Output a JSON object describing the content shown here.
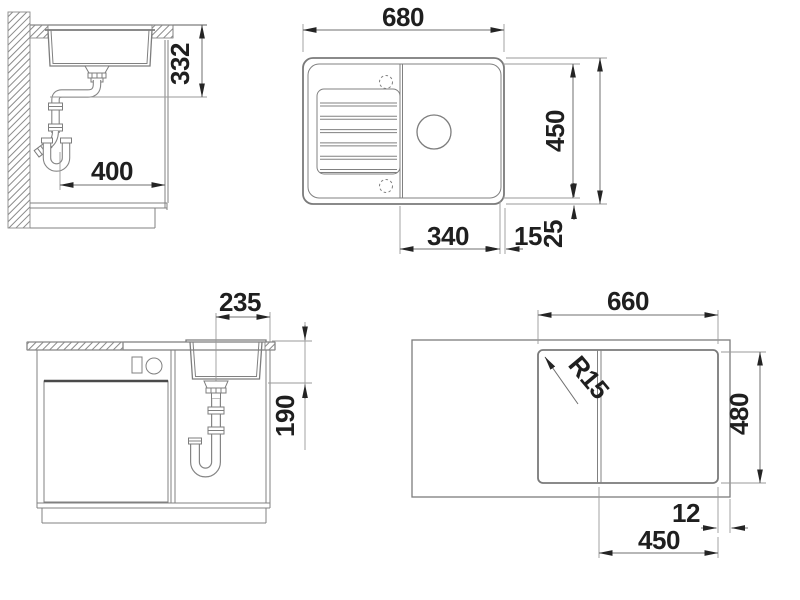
{
  "page": {
    "background_color": "#ffffff",
    "line_color": "#808080",
    "text_color": "#1f1f1f"
  },
  "drawing": {
    "type": "sink-installation-technical-drawing",
    "views": {
      "side_section": {
        "description": "side cross-section with wall, countertop, bowl and drain trap",
        "dims": {
          "counter_to_drain_height": "332",
          "wall_to_cabinet_front": "400"
        }
      },
      "plan": {
        "description": "top view of sink with drainboard, bowl, drain and tap holes",
        "dims": {
          "overall_width": "680",
          "inner_depth": "450",
          "overall_depth": "500",
          "bowl_width": "340",
          "rim_right": "15",
          "rim_bottom": "25"
        }
      },
      "front_section": {
        "description": "front view of base cabinet with bowl and siphon",
        "dims": {
          "drain_to_right_edge": "235",
          "bowl_depth": "190"
        }
      },
      "cutout": {
        "description": "worktop cutout plan",
        "dims": {
          "cutout_width": "660",
          "cutout_depth": "480",
          "corner_radius": "R15",
          "cutout_to_edge": "12",
          "bowl_section_width": "450"
        }
      }
    }
  }
}
